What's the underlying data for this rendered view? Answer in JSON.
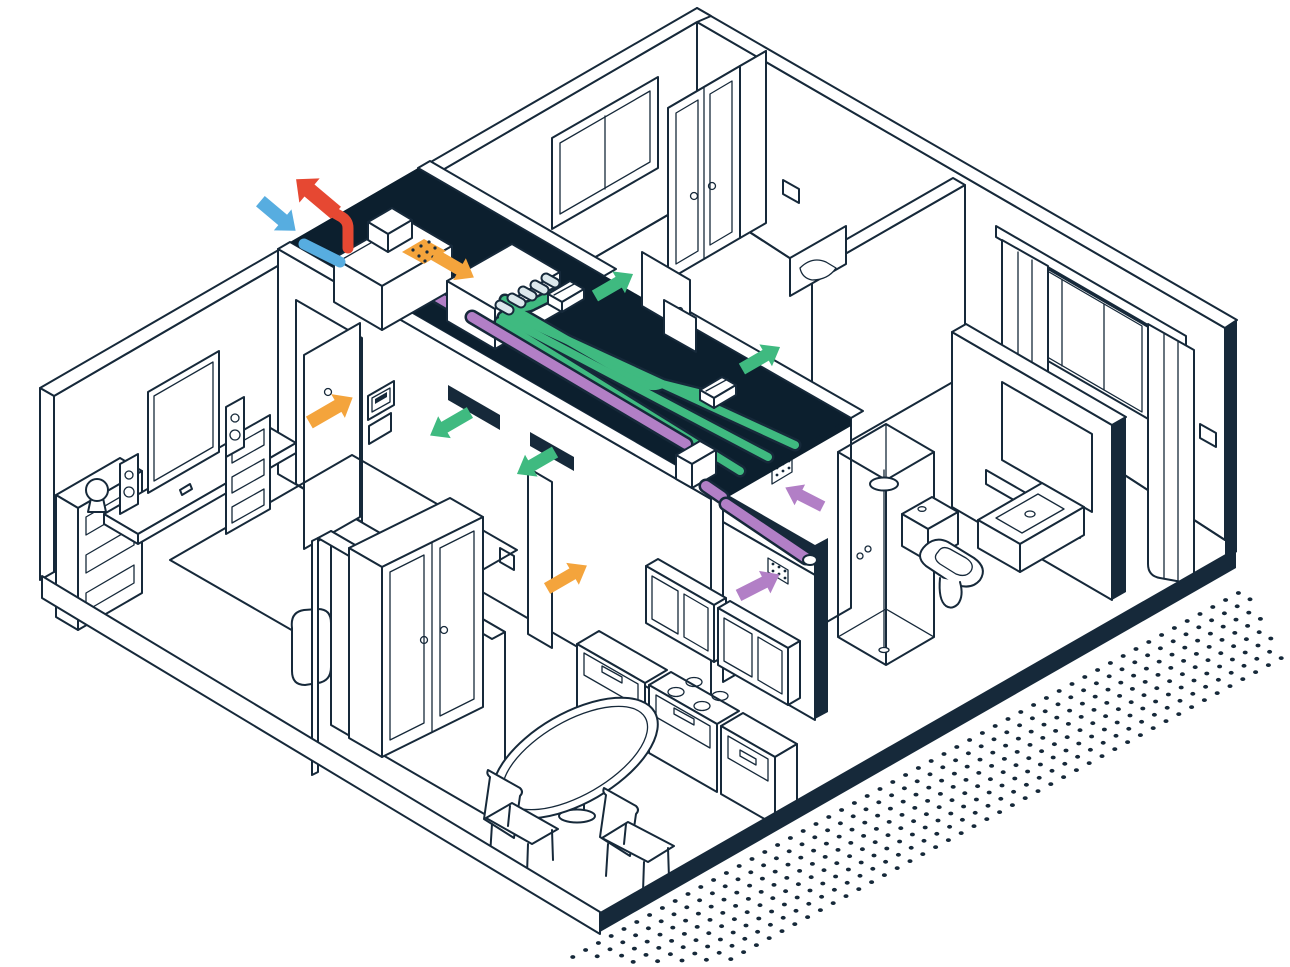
{
  "window": {
    "width": 1290,
    "height": 967
  },
  "colors": {
    "outline": "#16293a",
    "plenum": "#0c1f2e",
    "white": "#ffffff",
    "green": "#3fba80",
    "purple": "#b27fc6",
    "orange": "#f4a43c",
    "red": "#e64832",
    "blue": "#57ade0",
    "unit": "#dce8ec"
  },
  "diagram": {
    "type": "isometric-apartment-cutaway-ventilation-system",
    "rooms": [
      "living-room",
      "hallway",
      "bedroom-1",
      "bedroom-2",
      "bathroom",
      "kitchen-diner"
    ],
    "equipment": [
      "heat-recovery-ventilation-unit",
      "ceiling-plenum",
      "supply-manifold",
      "supply-ducts-green",
      "extract-duct-purple",
      "supply-vents",
      "extract-grilles",
      "exterior-intake",
      "exterior-exhaust"
    ],
    "arrows": [
      {
        "name": "exhaust-air-out",
        "color": "red",
        "x": 316,
        "y": 196,
        "deg": -140,
        "len": 52,
        "w": 15
      },
      {
        "name": "fresh-air-in",
        "color": "blue",
        "x": 278,
        "y": 216,
        "deg": 40,
        "len": 46,
        "w": 13
      },
      {
        "name": "supply-duct-flow",
        "color": "orange",
        "x": 454,
        "y": 266,
        "deg": 30,
        "len": 46,
        "w": 12
      },
      {
        "name": "supply-living-room",
        "color": "green",
        "x": 450,
        "y": 424,
        "deg": 150,
        "len": 46,
        "w": 12
      },
      {
        "name": "supply-hall",
        "color": "green",
        "x": 536,
        "y": 463,
        "deg": 150,
        "len": 44,
        "w": 12
      },
      {
        "name": "supply-bedroom-1",
        "color": "green",
        "x": 614,
        "y": 285,
        "deg": -30,
        "len": 44,
        "w": 12
      },
      {
        "name": "supply-bedroom-2",
        "color": "green",
        "x": 761,
        "y": 358,
        "deg": -30,
        "len": 44,
        "w": 12
      },
      {
        "name": "transfer-living-door",
        "color": "orange",
        "x": 331,
        "y": 410,
        "deg": -30,
        "len": 50,
        "w": 13
      },
      {
        "name": "transfer-kitchen-door",
        "color": "orange",
        "x": 567,
        "y": 577,
        "deg": -30,
        "len": 46,
        "w": 12
      },
      {
        "name": "extract-bathroom",
        "color": "purple",
        "x": 804,
        "y": 497,
        "deg": -153,
        "len": 42,
        "w": 11
      },
      {
        "name": "extract-kitchen",
        "color": "purple",
        "x": 759,
        "y": 585,
        "deg": -27,
        "len": 46,
        "w": 12
      }
    ],
    "dots": {
      "x1": 560,
      "y1": 964,
      "cols": 54,
      "col_dx": 12.8,
      "col_dy": -7.0,
      "rows": 8,
      "row_dx": 5.2,
      "row_dy": 9.8,
      "rx": 2.5,
      "ry": 1.9
    }
  }
}
